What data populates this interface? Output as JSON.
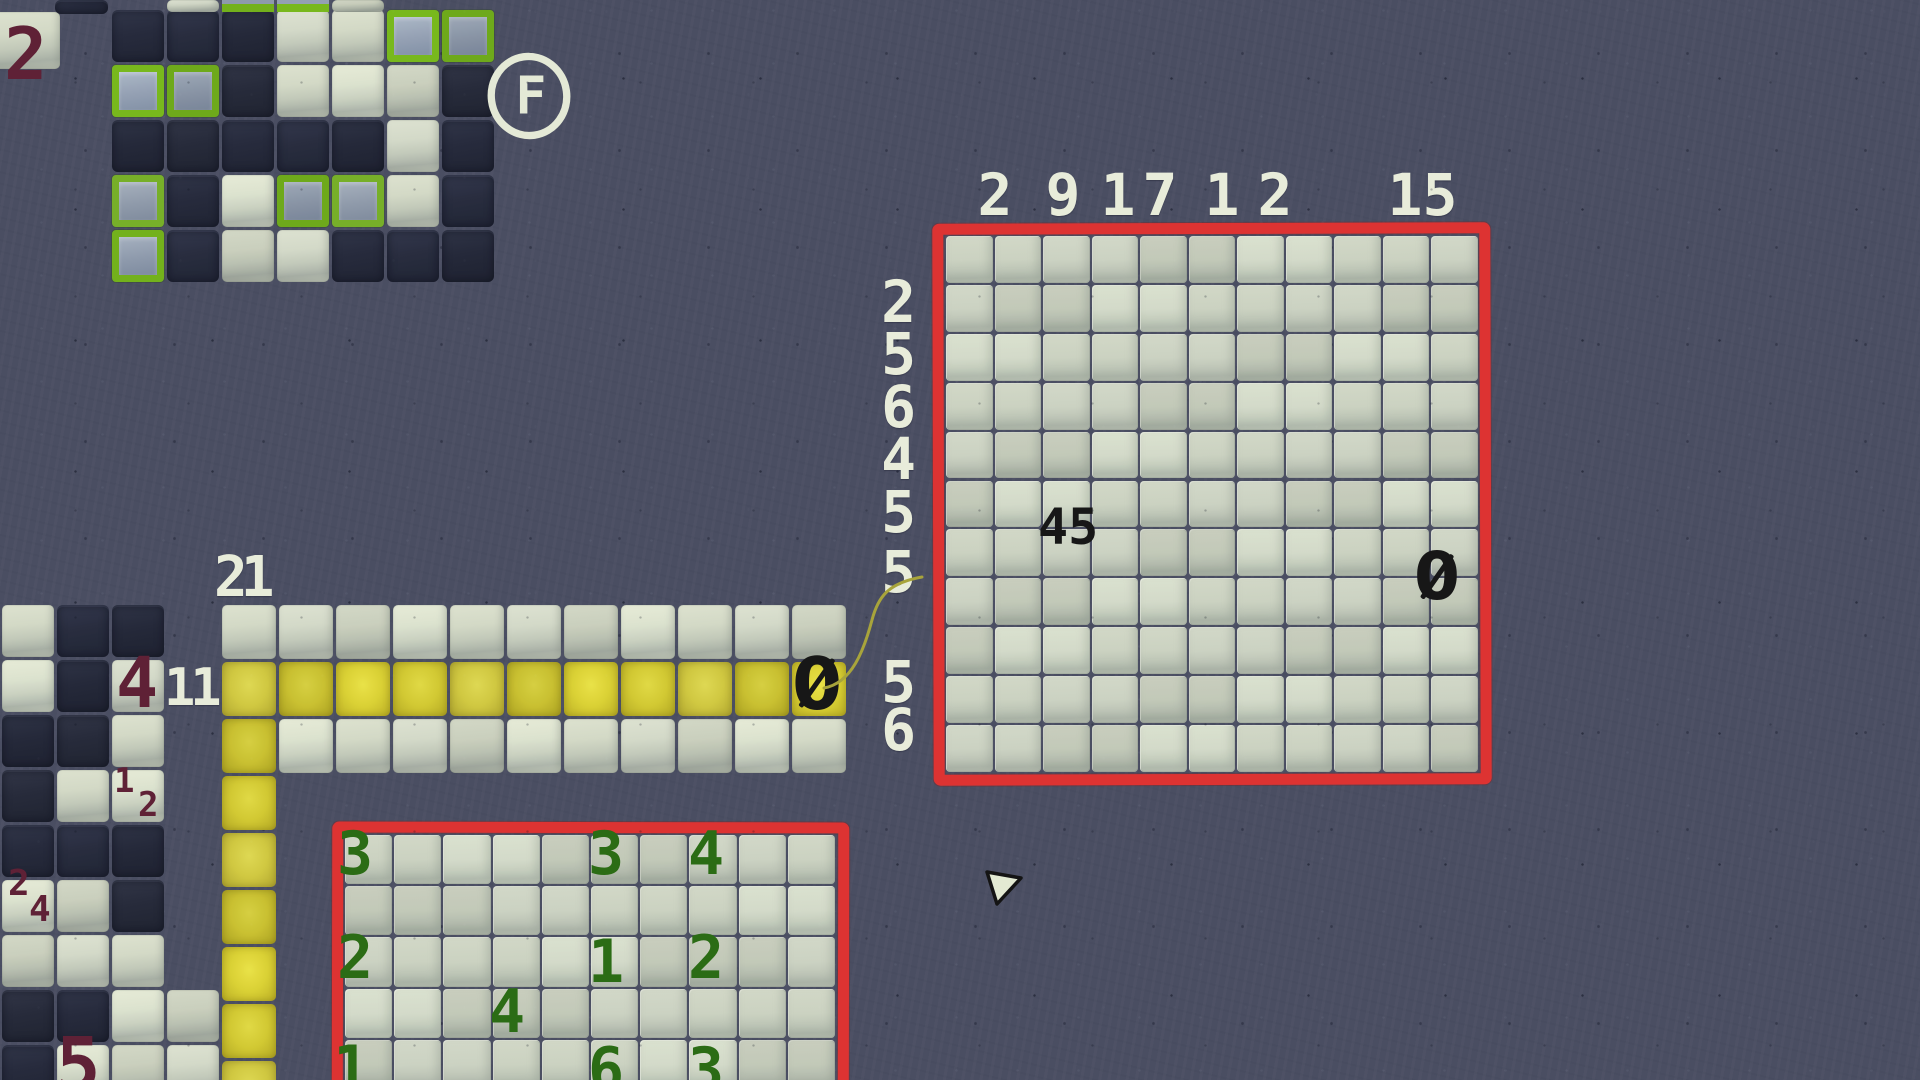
{
  "colors": {
    "background": "#4a4e62",
    "tile_dark": "#272b3d",
    "tile_light": "#d3d9c6",
    "tile_board_light": "#cbd2c1",
    "flag_fill": "#8e9aac",
    "flag_border": "#73b11c",
    "path_yellow": "#d2c933",
    "frame_red": "#dd3332",
    "clue_white": "#e8ecda",
    "clue_maroon": "#5f2136",
    "clue_green": "#2b6c15",
    "ink_black": "#171717",
    "connector_olive": "#a8a43b",
    "ui_pale": "#e4e9d6"
  },
  "flag_button": {
    "label": "F"
  },
  "big_grid": {
    "top_y": 166,
    "left_x": 872,
    "font": 58,
    "top_clues": [
      {
        "v": "2",
        "x": 973
      },
      {
        "v": "9",
        "x": 1041
      },
      {
        "v": "1",
        "x": 1096
      },
      {
        "v": "7",
        "x": 1138
      },
      {
        "v": "1",
        "x": 1200
      },
      {
        "v": "2",
        "x": 1253
      },
      {
        "v": "1",
        "x": 1383
      },
      {
        "v": "5",
        "x": 1418
      }
    ],
    "left_clues": [
      {
        "v": "2",
        "y": 273
      },
      {
        "v": "5",
        "y": 325
      },
      {
        "v": "6",
        "y": 378
      },
      {
        "v": "4",
        "y": 430
      },
      {
        "v": "5",
        "y": 483
      },
      {
        "v": "5",
        "y": 543
      },
      {
        "v": "5",
        "y": 653
      },
      {
        "v": "6",
        "y": 701
      }
    ]
  },
  "boards": [
    {
      "name": "top-left-board",
      "x": 112,
      "y": 10,
      "cw": 55,
      "ch": 55,
      "gap": 3,
      "rows": [
        "dddllff",
        "ffdllld",
        "dddddld",
        "fdlffld",
        "fdllddd"
      ],
      "extra": [
        {
          "x": -122,
          "y": 2,
          "w": 70,
          "h": 57,
          "s": "l"
        },
        {
          "x": -57,
          "y": -10,
          "w": 53,
          "h": 14,
          "s": "d"
        },
        {
          "x": 55,
          "y": -10,
          "w": 52,
          "h": 12,
          "s": "l"
        },
        {
          "x": 110,
          "y": -10,
          "w": 52,
          "h": 12,
          "s": "b"
        },
        {
          "x": 165,
          "y": -10,
          "w": 52,
          "h": 12,
          "s": "b"
        },
        {
          "x": 220,
          "y": -10,
          "w": 52,
          "h": 12,
          "s": "l"
        }
      ]
    },
    {
      "name": "left-board",
      "x": 2,
      "y": 605,
      "cw": 55,
      "ch": 55,
      "gap": 3,
      "rows": [
        "ldd",
        "ldl",
        "ddl",
        "dll",
        "ddd",
        "lld",
        "lll",
        "ddll",
        "dlll"
      ]
    },
    {
      "name": "strip-board",
      "x": 222,
      "y": 605,
      "cw": 57,
      "ch": 57,
      "gap": 3,
      "rows": [
        "lllllllllll",
        "yyyyyyyyyyy",
        "yllllllllll"
      ]
    },
    {
      "name": "yellow-path-column",
      "x": 222,
      "y": 776,
      "cw": 57,
      "ch": 57,
      "gap": 3,
      "rows": [
        "y",
        "y",
        "y",
        "y",
        "y",
        "y"
      ]
    },
    {
      "name": "big-board",
      "x": 946,
      "y": 236,
      "cw": 48.5,
      "ch": 48.9,
      "gap": 2,
      "rows": [
        "ggggggggggg",
        "ggggggggggg",
        "ggggggggggg",
        "ggggggggggg",
        "ggggggggggg",
        "ggggggggggg",
        "ggggggggggg",
        "ggggggggggg",
        "ggggggggggg",
        "ggggggggggg",
        "ggggggggggg"
      ]
    },
    {
      "name": "bottom-board",
      "x": 345,
      "y": 835,
      "cw": 49.2,
      "ch": 51.2,
      "gap": 2,
      "rows": [
        "gggggggggg",
        "gggggggggg",
        "gggggggggg",
        "gggggggggg",
        "gggggggggg"
      ]
    }
  ],
  "labels": [
    {
      "t": "2",
      "x": 4,
      "y": 18,
      "size": 72,
      "color": "maroon",
      "name": "clue-2-top-left-board"
    },
    {
      "t": "21",
      "x": 214,
      "y": 550,
      "size": 56,
      "ls": -7,
      "color": "white",
      "name": "clue-21-strip-column"
    },
    {
      "t": "11",
      "x": 164,
      "y": 662,
      "size": 52,
      "ls": -5,
      "color": "white",
      "name": "clue-11-strip-row"
    },
    {
      "t": "4",
      "x": 116,
      "y": 648,
      "size": 70,
      "color": "maroon",
      "name": "clue-4-left-board"
    },
    {
      "t": "1",
      "x": 114,
      "y": 764,
      "size": 34,
      "color": "maroon",
      "name": "clue-pair-1"
    },
    {
      "t": "2",
      "x": 138,
      "y": 788,
      "size": 34,
      "color": "maroon",
      "name": "clue-pair-2"
    },
    {
      "t": "2",
      "x": 8,
      "y": 866,
      "size": 36,
      "color": "maroon",
      "name": "clue-pair-2b"
    },
    {
      "t": "4",
      "x": 29,
      "y": 892,
      "size": 36,
      "color": "maroon",
      "name": "clue-pair-4"
    },
    {
      "t": "5",
      "x": 56,
      "y": 1028,
      "size": 74,
      "color": "maroon",
      "name": "clue-5-bottom-left"
    },
    {
      "t": "45",
      "x": 1038,
      "y": 502,
      "size": 50,
      "color": "ink",
      "name": "pencil-note-45-big-board"
    },
    {
      "t": "0",
      "x": 1414,
      "y": 544,
      "size": 66,
      "color": "ink",
      "slashed": true,
      "name": "pencil-note-0-big-board"
    },
    {
      "t": "0",
      "x": 792,
      "y": 648,
      "size": 72,
      "color": "ink",
      "slashed": true,
      "name": "pencil-note-0-strip"
    },
    {
      "t": "3",
      "x": 337,
      "y": 824,
      "size": 60,
      "color": "green",
      "name": "clue-3-bottom-board-r0c0"
    },
    {
      "t": "3",
      "x": 588,
      "y": 824,
      "size": 60,
      "color": "green",
      "name": "clue-3-bottom-board-r0c5"
    },
    {
      "t": "4",
      "x": 688,
      "y": 824,
      "size": 60,
      "color": "green",
      "name": "clue-4-bottom-board-r0c7"
    },
    {
      "t": "2",
      "x": 337,
      "y": 928,
      "size": 60,
      "color": "green",
      "name": "clue-2-bottom-board-r2c0"
    },
    {
      "t": "1",
      "x": 588,
      "y": 932,
      "size": 60,
      "color": "green",
      "name": "clue-1-bottom-board-r2c5"
    },
    {
      "t": "2",
      "x": 688,
      "y": 928,
      "size": 60,
      "color": "green",
      "name": "clue-2-bottom-board-r2c7"
    },
    {
      "t": "4",
      "x": 489,
      "y": 982,
      "size": 60,
      "color": "green",
      "name": "clue-4-bottom-board-r3c3"
    },
    {
      "t": "1",
      "x": 333,
      "y": 1038,
      "size": 60,
      "color": "green",
      "name": "clue-1-bottom-board-r4c0"
    },
    {
      "t": "6",
      "x": 588,
      "y": 1040,
      "size": 60,
      "color": "green",
      "name": "clue-6-bottom-board-r4c5"
    },
    {
      "t": "3",
      "x": 688,
      "y": 1040,
      "size": 60,
      "color": "green",
      "name": "clue-3-bottom-board-r4c7"
    }
  ]
}
